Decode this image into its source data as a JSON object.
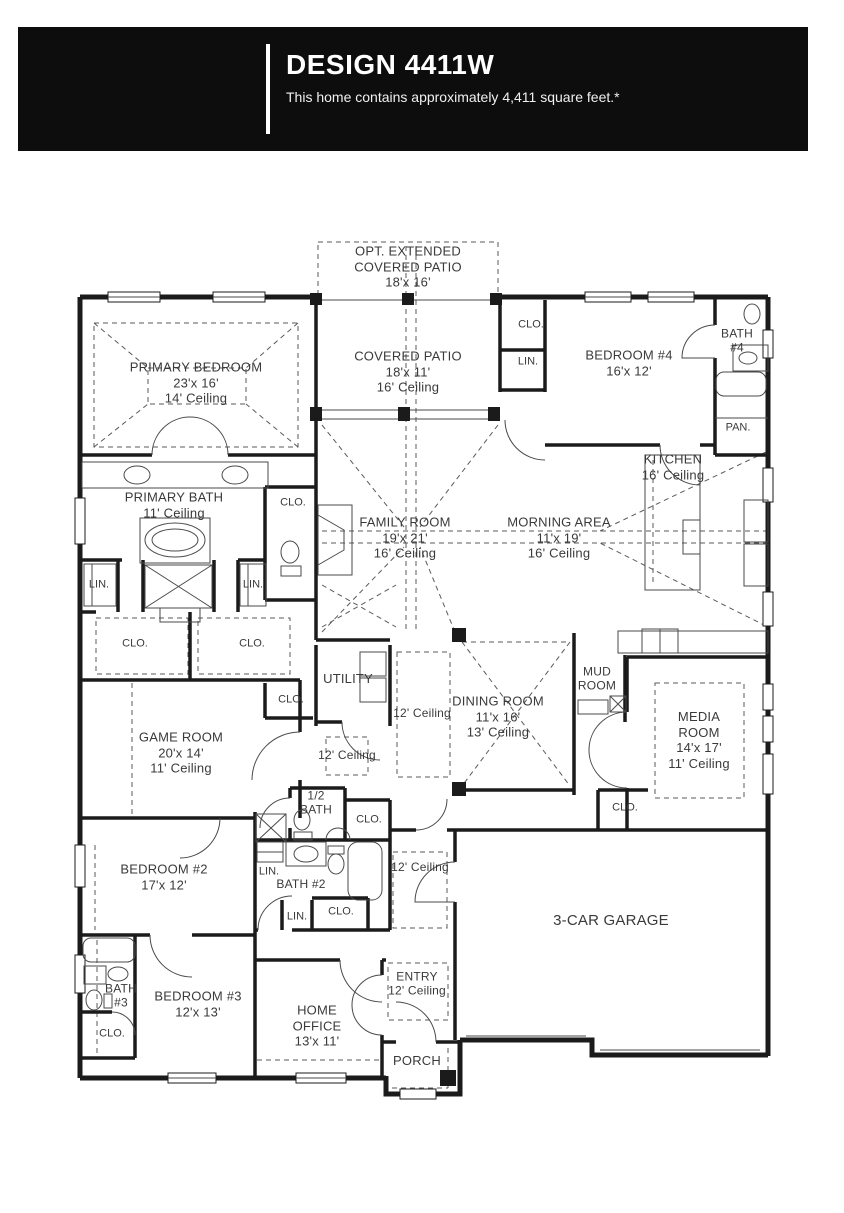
{
  "header": {
    "title": "DESIGN 4411W",
    "subtitle": "This home contains approximately 4,411 square feet.*"
  },
  "plan": {
    "opt_patio": {
      "l1": "OPT. EXTENDED",
      "l2": "COVERED PATIO",
      "l3": "18'x 16'"
    },
    "covered_patio": {
      "l1": "COVERED PATIO",
      "l2": "18'x 11'",
      "l3": "16' Ceiling"
    },
    "primary_bedroom": {
      "l1": "PRIMARY BEDROOM",
      "l2": "23'x 16'",
      "l3": "14' Ceiling"
    },
    "bedroom4": {
      "l1": "BEDROOM #4",
      "l2": "16'x 12'"
    },
    "bath4": {
      "l1": "BATH",
      "l2": "#4"
    },
    "pan": {
      "l1": "PAN."
    },
    "kitchen": {
      "l1": "KITCHEN",
      "l2": "16' Ceiling"
    },
    "primary_bath": {
      "l1": "PRIMARY BATH",
      "l2": "11' Ceiling"
    },
    "family_room": {
      "l1": "FAMILY ROOM",
      "l2": "19'x 21'",
      "l3": "16' Ceiling"
    },
    "morning_area": {
      "l1": "MORNING AREA",
      "l2": "11'x 19'",
      "l3": "16' Ceiling"
    },
    "utility": {
      "l1": "UTILITY"
    },
    "game_room": {
      "l1": "GAME ROOM",
      "l2": "20'x 14'",
      "l3": "11' Ceiling"
    },
    "dining_room": {
      "l1": "DINING ROOM",
      "l2": "11'x 16'",
      "l3": "13' Ceiling"
    },
    "mud_room": {
      "l1": "MUD",
      "l2": "ROOM"
    },
    "media_room": {
      "l1": "MEDIA",
      "l2": "ROOM",
      "l3": "14'x 17'",
      "l4": "11' Ceiling"
    },
    "half_bath": {
      "l1": "1/2",
      "l2": "BATH"
    },
    "bath2": {
      "l1": "BATH #2"
    },
    "bedroom2": {
      "l1": "BEDROOM #2",
      "l2": "17'x 12'"
    },
    "garage": {
      "l1": "3-CAR GARAGE"
    },
    "bath3": {
      "l1": "BATH",
      "l2": "#3"
    },
    "bedroom3": {
      "l1": "BEDROOM #3",
      "l2": "12'x 13'"
    },
    "home_office": {
      "l1": "HOME",
      "l2": "OFFICE",
      "l3": "13'x 11'"
    },
    "entry": {
      "l1": "ENTRY",
      "l2": "12' Ceiling"
    },
    "porch": {
      "l1": "PORCH"
    },
    "ceiling12": {
      "l1": "12' Ceiling"
    },
    "clo": "CLO.",
    "lin": "LIN."
  }
}
